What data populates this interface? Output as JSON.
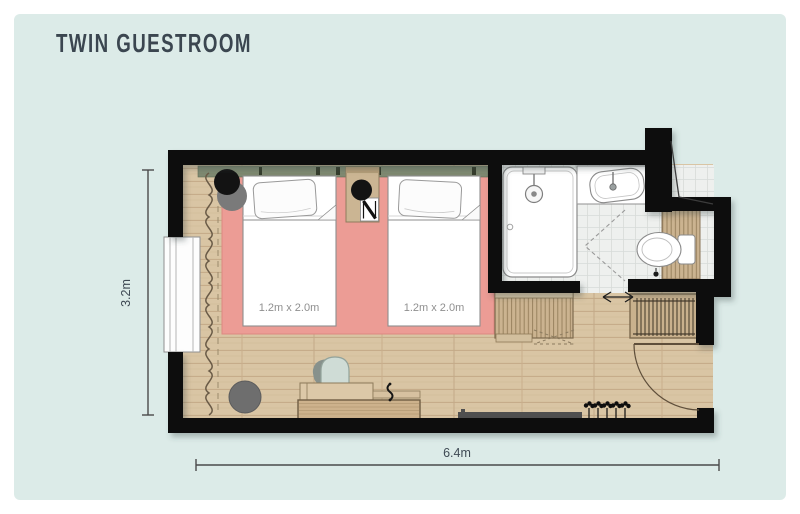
{
  "page": {
    "title": "TWIN GUESTROOM"
  },
  "dimensions": {
    "horizontal": "6.4m",
    "vertical": "3.2m"
  },
  "beds": [
    {
      "label": "1.2m x 2.0m"
    },
    {
      "label": "1.2m x 2.0m"
    }
  ],
  "furniture_legend": [
    "twin-bed-left",
    "twin-bed-right",
    "nightstand",
    "table-lamp",
    "floor-lamp",
    "pouf",
    "desk",
    "desk-chair",
    "bench-luggage-rack",
    "wardrobe-hangers",
    "plant",
    "tv-ledge",
    "shower-tub",
    "sink-counter",
    "toilet",
    "window",
    "curtain",
    "entry-door",
    "bathroom-door",
    "rug"
  ],
  "colors": {
    "canvas": "#dcebe8",
    "wall": "#101010",
    "floor_wood": "#d9c5a4",
    "rug": "#ec9c95",
    "headboard": "#7e8971",
    "furniture_wood": "#cbb390",
    "tile": "#eef0ee",
    "chair": "#cfdcd6",
    "title_text": "#3b4650",
    "dimension_text": "#3f4a54"
  }
}
